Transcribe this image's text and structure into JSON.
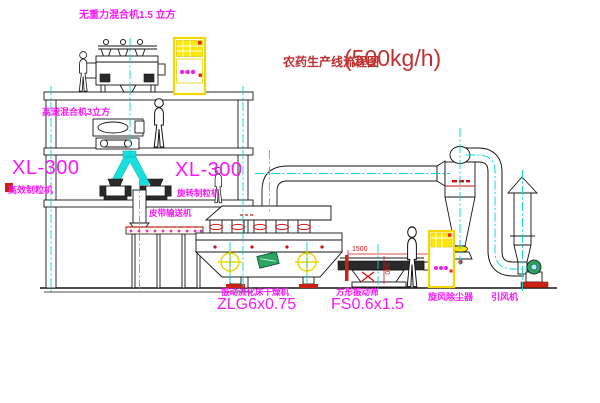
{
  "title": {
    "text": "农药生产线流程图",
    "capacity": "(500kg/h)"
  },
  "labels": {
    "gravity_mixer": "无重力混合机1.5 立方",
    "high_speed_mixer": "高速混合机3立方",
    "granulator_left": {
      "model": "XL-300",
      "name": "高效制粒机"
    },
    "granulator_right": {
      "model": "XL-300",
      "name": "旋转制粒机"
    },
    "belt_conveyor": "皮带输送机",
    "fluid_bed_dryer": {
      "name": "振动流化床干燥机",
      "model": "ZLG6x0.75"
    },
    "square_vibrating_screen": {
      "name": "方形振动筛",
      "model": "FS0.6x1.5"
    },
    "cyclone_dust_collector": "旋风除尘器",
    "induced_draft_fan": "引风机"
  },
  "dimensions": {
    "screen_length": "1500",
    "screen_height": "540"
  },
  "colors": {
    "label_magenta": "#f818f8",
    "title_red": "#c22f2f",
    "dimension_red": "#d01818",
    "centerline_cyan": "#00d8d8",
    "cabinet_yellow": "#f0e000",
    "chute_cyan": "#19dede",
    "symbol_green": "#2aa35d"
  }
}
